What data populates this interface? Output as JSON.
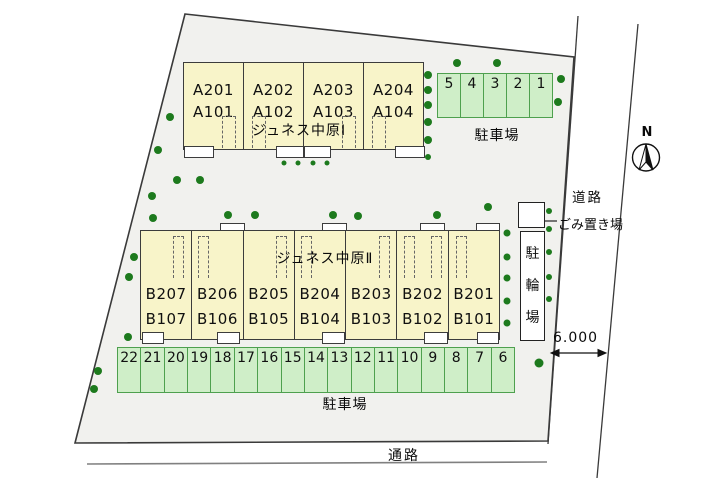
{
  "buildings": [
    {
      "id": "A",
      "name": "ジュネス中原Ⅰ",
      "units": [
        {
          "upper": "A201",
          "lower": "A101"
        },
        {
          "upper": "A202",
          "lower": "A102"
        },
        {
          "upper": "A203",
          "lower": "A103"
        },
        {
          "upper": "A204",
          "lower": "A104"
        }
      ]
    },
    {
      "id": "B",
      "name": "ジュネス中原Ⅱ",
      "units": [
        {
          "upper": "B207",
          "lower": "B107"
        },
        {
          "upper": "B206",
          "lower": "B106"
        },
        {
          "upper": "B205",
          "lower": "B105"
        },
        {
          "upper": "B204",
          "lower": "B104"
        },
        {
          "upper": "B203",
          "lower": "B103"
        },
        {
          "upper": "B202",
          "lower": "B102"
        },
        {
          "upper": "B201",
          "lower": "B101"
        }
      ]
    }
  ],
  "parking_top": {
    "label": "駐車場",
    "stalls": [
      "5",
      "4",
      "3",
      "2",
      "1"
    ]
  },
  "parking_bottom": {
    "label": "駐車場",
    "stalls": [
      "22",
      "21",
      "20",
      "19",
      "18",
      "17",
      "16",
      "15",
      "14",
      "13",
      "12",
      "11",
      "10",
      "9",
      "8",
      "7",
      "6"
    ]
  },
  "labels": {
    "road": "道路",
    "garbage": "ごみ置き場",
    "bicycle": "駐輪場",
    "passage": "通路",
    "dimension": "6.000",
    "north": "N"
  },
  "site": {
    "trees": [
      [
        457,
        63,
        4
      ],
      [
        497,
        63,
        4
      ],
      [
        561,
        79,
        4
      ],
      [
        558,
        102,
        4
      ],
      [
        428,
        75,
        4
      ],
      [
        428,
        90,
        4
      ],
      [
        428,
        105,
        4
      ],
      [
        428,
        122,
        4
      ],
      [
        428,
        140,
        4
      ],
      [
        428,
        157,
        3
      ],
      [
        284,
        163,
        2.5
      ],
      [
        298,
        163,
        2.5
      ],
      [
        313,
        163,
        2.5
      ],
      [
        327,
        163,
        2.5
      ],
      [
        170,
        117,
        4
      ],
      [
        158,
        150,
        4
      ],
      [
        177,
        180,
        4
      ],
      [
        200,
        180,
        4
      ],
      [
        152,
        196,
        4
      ],
      [
        153,
        218,
        4
      ],
      [
        228,
        215,
        4
      ],
      [
        255,
        215,
        4
      ],
      [
        333,
        215,
        4
      ],
      [
        358,
        216,
        4
      ],
      [
        437,
        215,
        4
      ],
      [
        488,
        207,
        4
      ],
      [
        134,
        257,
        4
      ],
      [
        129,
        277,
        4
      ],
      [
        128,
        337,
        4
      ],
      [
        98,
        371,
        4
      ],
      [
        94,
        389,
        4
      ],
      [
        507,
        233,
        3.5
      ],
      [
        507,
        257,
        3.5
      ],
      [
        507,
        278,
        3.5
      ],
      [
        507,
        301,
        3.5
      ],
      [
        507,
        323,
        3.5
      ],
      [
        549,
        211,
        3
      ],
      [
        549,
        229,
        3
      ],
      [
        549,
        252,
        3
      ],
      [
        549,
        277,
        3
      ],
      [
        549,
        299,
        3
      ],
      [
        539,
        363,
        4.5
      ]
    ]
  },
  "colors": {
    "building": "#f8f4c9",
    "stall_fill": "#cfeec8",
    "stall_border": "#4ea04e",
    "tree": "#1d7a1d",
    "site_fill": "#f1f1ee",
    "line": "#3a3a3a"
  }
}
